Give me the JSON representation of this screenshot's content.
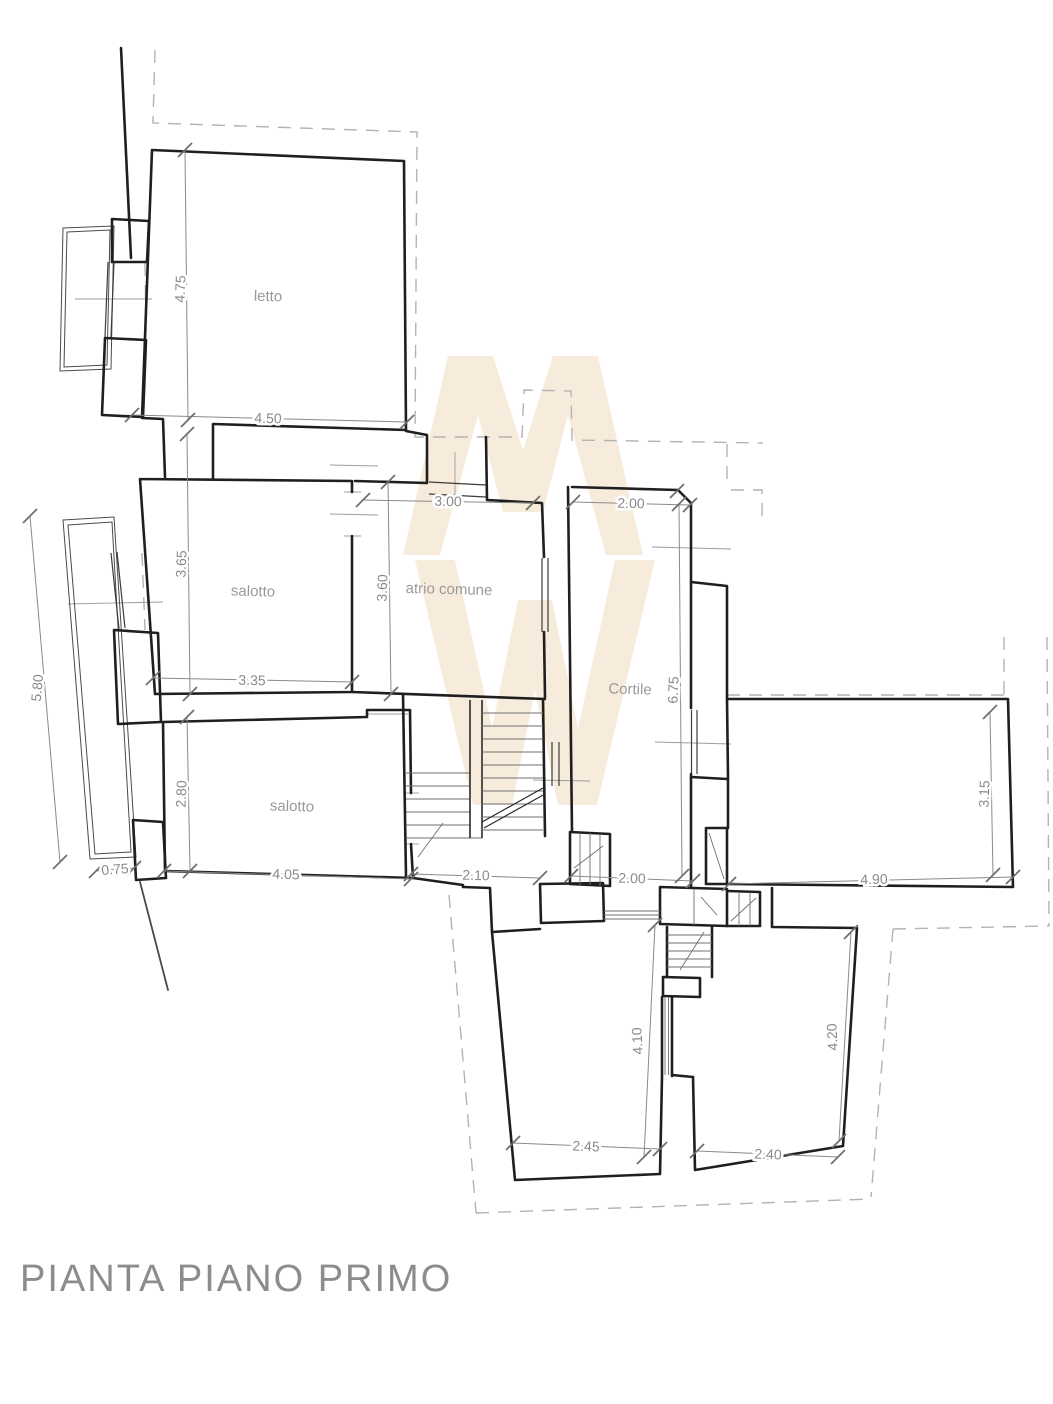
{
  "title": "PIANTA PIANO PRIMO",
  "rooms": {
    "letto": "letto",
    "salotto_upper": "salotto",
    "atrio": "atrio comune",
    "cortile": "Cortile",
    "salotto_lower": "salotto"
  },
  "dims": {
    "v475": "4.75",
    "h450": "4.50",
    "v365": "3.65",
    "h335": "3.35",
    "v360": "3.60",
    "h300": "3.00",
    "h200_top": "2.00",
    "v675": "6.75",
    "v580": "5.80",
    "v280": "2.80",
    "h405": "4.05",
    "h075": "0.75",
    "h210": "2.10",
    "h200_bottom": "2.00",
    "h490": "4.90",
    "v315": "3.15",
    "v410": "4.10",
    "v420": "4.20",
    "h245": "2.45",
    "h240": "2.40"
  },
  "watermark": {
    "letters": "MW",
    "color": "#f7ecdb"
  },
  "colors": {
    "walls": "#1f1f1f",
    "dimensions": "#8a8a8a",
    "dashed": "#b3b3b3",
    "title": "#8c8c8c",
    "background": "#ffffff"
  }
}
